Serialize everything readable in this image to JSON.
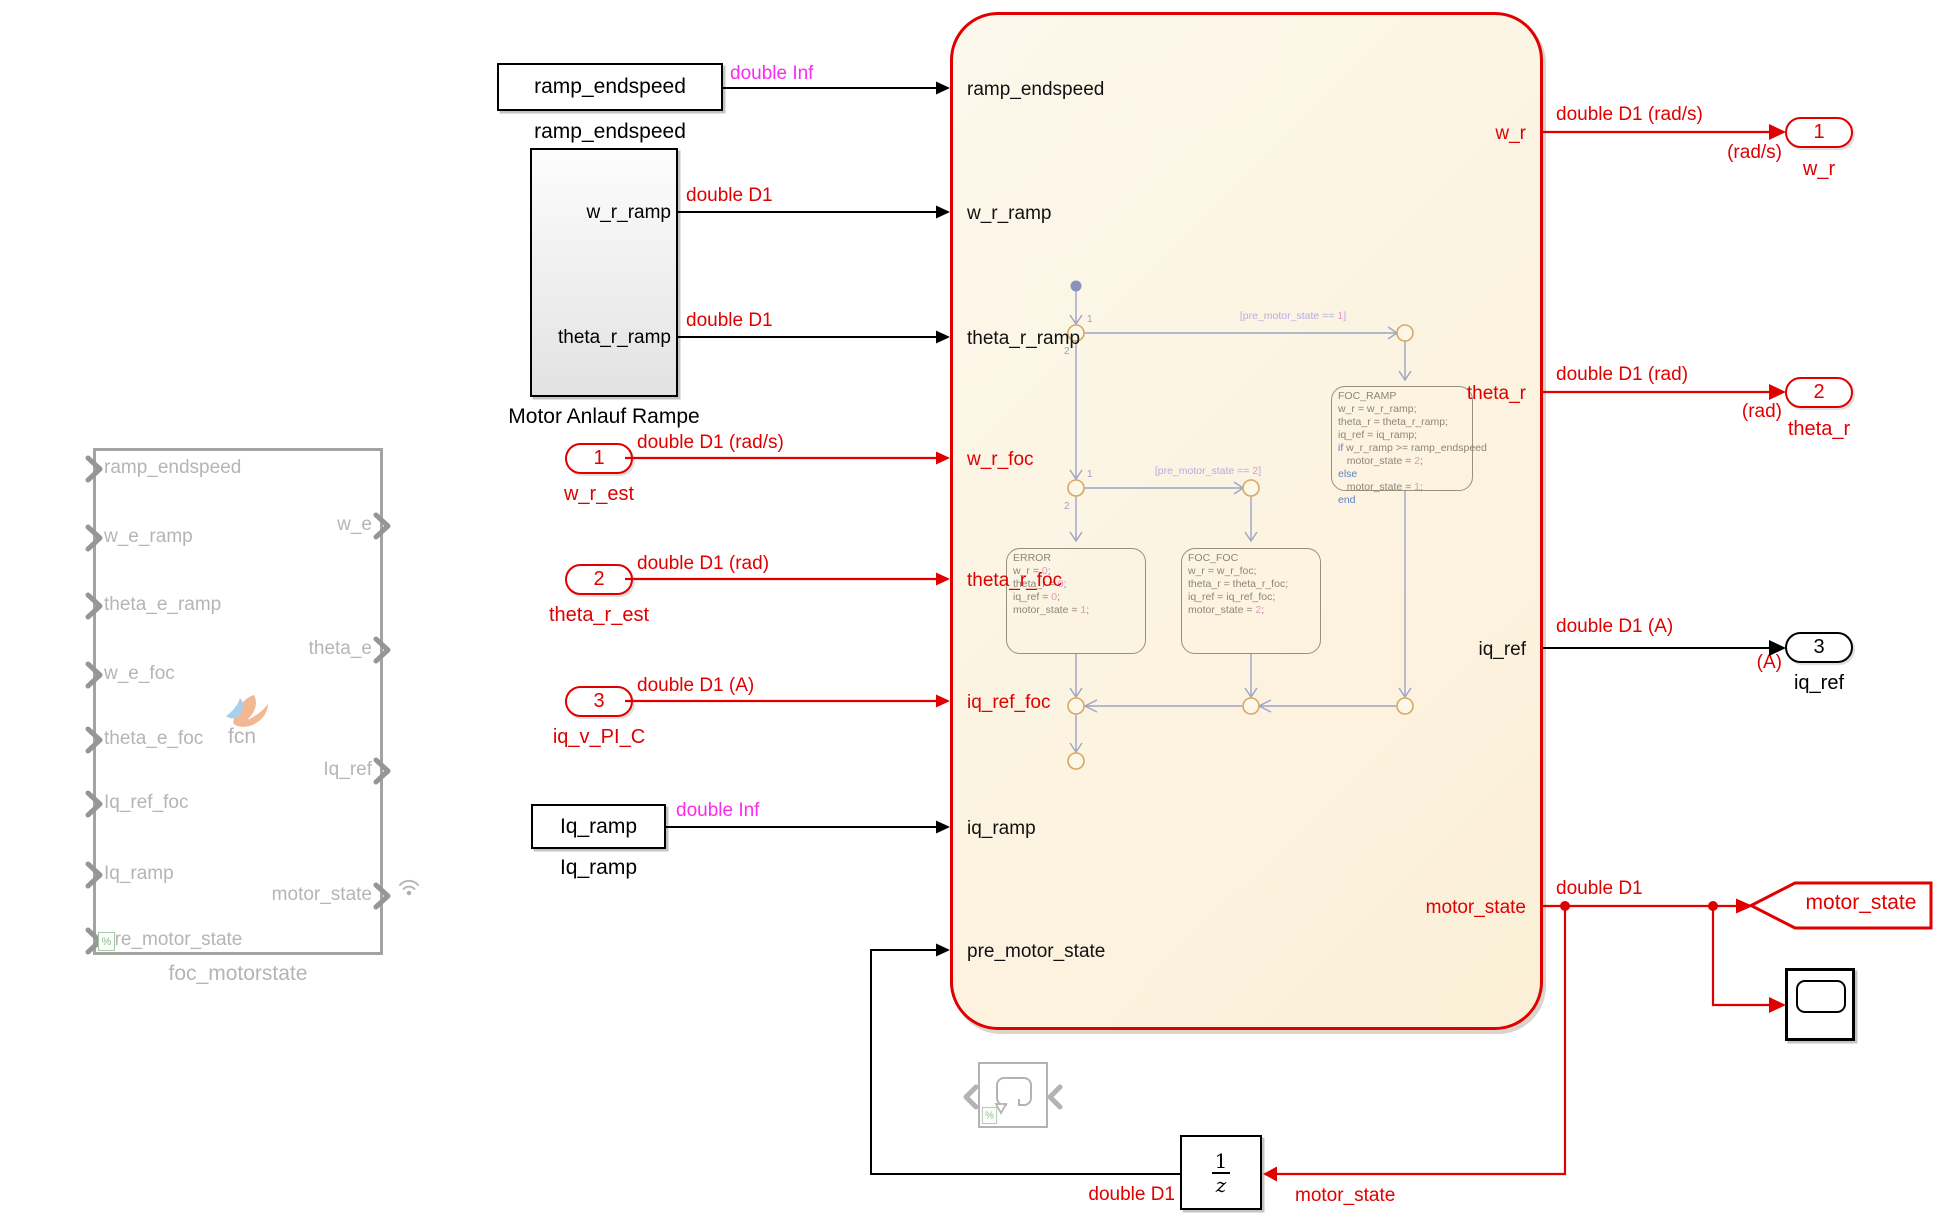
{
  "colors": {
    "signal_red": "#e00000",
    "magenta": "#fb2af2",
    "chart_fill": "#fdf5e1",
    "disabled_gray": "#b5b5b5",
    "state_ink": "#8d8577",
    "transition_ink": "#9da4c6"
  },
  "ghost_block": {
    "label": "foc_motorstate",
    "fcn_label": "fcn",
    "comment_badge": "%",
    "inputs": [
      "ramp_endspeed",
      "w_e_ramp",
      "theta_e_ramp",
      "w_e_foc",
      "theta_e_foc",
      "Iq_ref_foc",
      "Iq_ramp",
      "pre_motor_state"
    ],
    "outputs": [
      "w_e",
      "theta_e",
      "Iq_ref",
      "motor_state"
    ]
  },
  "constants": {
    "ramp_endspeed": {
      "text": "ramp_endspeed",
      "label": "ramp_endspeed"
    },
    "iq_ramp": {
      "text": "Iq_ramp",
      "label": "Iq_ramp"
    }
  },
  "ramp_subsystem": {
    "label": "Motor Anlauf Rampe",
    "ports": [
      "w_r_ramp",
      "theta_r_ramp"
    ]
  },
  "inports": [
    {
      "number": "1",
      "label": "w_r_est"
    },
    {
      "number": "2",
      "label": "theta_r_est"
    },
    {
      "number": "3",
      "label": "iq_v_PI_C"
    }
  ],
  "chart": {
    "inputs": [
      "ramp_endspeed",
      "w_r_ramp",
      "theta_r_ramp",
      "w_r_foc",
      "theta_r_foc",
      "iq_ref_foc",
      "iq_ramp",
      "pre_motor_state"
    ],
    "outputs": [
      "w_r",
      "theta_r",
      "iq_ref",
      "motor_state"
    ]
  },
  "statechart": {
    "transitions": [
      "[pre_motor_state == 1]",
      "[pre_motor_state == 2]"
    ],
    "priorities": [
      "1",
      "2",
      "1",
      "2"
    ],
    "states": [
      {
        "name": "ERROR",
        "lines": [
          "w_r = 0;",
          "theta_r = 0;",
          "iq_ref = 0;",
          "motor_state = 1;"
        ]
      },
      {
        "name": "FOC_FOC",
        "lines": [
          "w_r = w_r_foc;",
          "theta_r = theta_r_foc;",
          "iq_ref = iq_ref_foc;",
          "motor_state = 2;"
        ]
      },
      {
        "name": "FOC_RAMP",
        "lines": [
          "w_r = w_r_ramp;",
          "theta_r = theta_r_ramp;",
          "iq_ref = iq_ramp;",
          "if w_r_ramp >= ramp_endspeed",
          "   motor_state = 2;",
          "else",
          "   motor_state = 1;",
          "end"
        ]
      }
    ]
  },
  "outports": [
    {
      "number": "1",
      "unit": "(rad/s)",
      "label": "w_r"
    },
    {
      "number": "2",
      "unit": "(rad)",
      "label": "theta_r"
    },
    {
      "number": "3",
      "unit": "(A)",
      "label": "iq_ref"
    }
  ],
  "goto_tag": {
    "label": "motor_state"
  },
  "unit_delay": {
    "numerator": "1",
    "denominator": "z"
  },
  "signal_labels": {
    "ramp_endspeed_type": "double Inf",
    "iq_ramp_type": "double Inf",
    "w_r_ramp_type": "double D1",
    "theta_r_ramp_type": "double D1",
    "w_r_est_type": "double D1 (rad/s)",
    "theta_r_est_type": "double D1 (rad)",
    "iq_v_type": "double D1 (A)",
    "w_r_out_type": "double D1 (rad/s)",
    "theta_r_out_type": "double D1 (rad)",
    "iq_ref_out_type": "double D1 (A)",
    "motor_state_type": "double D1",
    "delay_out_type": "double D1",
    "delay_in_label": "motor_state"
  }
}
